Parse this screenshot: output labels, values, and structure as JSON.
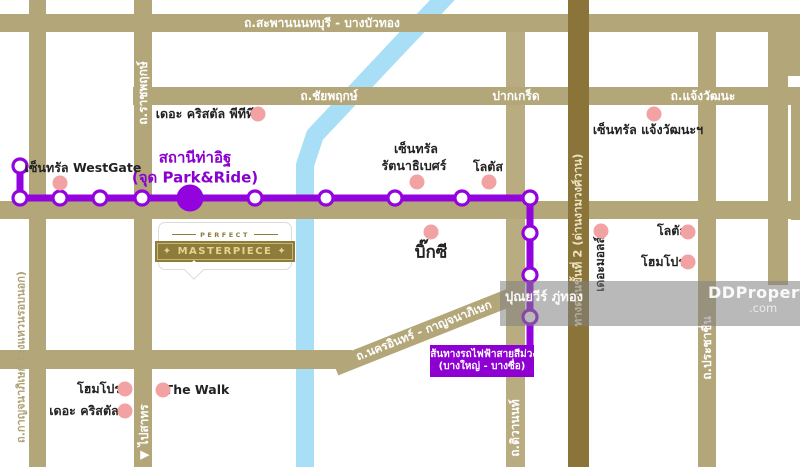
{
  "watermark": {
    "agent": "ปุณยวีร์ ภู่ทอง",
    "brand": "DDProperty",
    "brand_suffix": ".com"
  },
  "logo": {
    "eyebrow": "PERFECT",
    "name": "✦ MASTERPIECE ✦"
  },
  "metro": {
    "station": "สถานีท่าอิฐ",
    "station_note": "(จุด Park&Ride)",
    "route_line1": "เส้นทางรถไฟฟ้าสายสีม่วง",
    "route_line2": "(บางใหญ่ - บางซื่อ)"
  },
  "roads": {
    "saphan_nonthaburi": "ถ.สะพานนนทบุรี - บางบัวทอง",
    "chaiyaphruek": "ถ.ชัยพฤกษ์",
    "pak_kret": "ปากเกร็ด",
    "chaengwattana": "ถ.แจ้งวัฒนะ",
    "ratchaphruek": "ถ.ราชพฤกษ์",
    "kanchanaphisek": "ถ.กาญจนาภิเษก (วงแหวนรอบนอก)",
    "nakhon_in": "ถ.นครอินทร์ - กาญจนาภิเษก",
    "tiwanon": "ถ.ติวานนท์",
    "expressway": "ทางด่วนขั้นที่ 2 (ด่านงามวงศ์วาน)",
    "prachachuen": "ถ.ประชาชื่น",
    "to_sathorn": "▼ ไปสาทร"
  },
  "pois": {
    "crystal_ptt": "เดอะ คริสตัล พีทีที",
    "central_westgate": "เซ็นทรัล WestGate",
    "central_rattanathibet_1": "เซ็นทรัล",
    "central_rattanathibet_2": "รัตนาธิเบศร์",
    "lotus_rattanathibet": "โลตัส",
    "central_chaengwattana": "เซ็นทรัล แจ้งวัฒนะฯ",
    "big_c": "บิ๊กซี",
    "the_mall": "เดอะมอลล์",
    "lotus_chaengwattana": "โลตัส",
    "homepro_prachachuen": "โฮมโปร",
    "homepro_west": "โฮมโปร",
    "the_crystal": "เดอะ คริสตัล",
    "the_walk": "The Walk"
  },
  "colors": {
    "road": "#B3A77A",
    "road_dark_expressway": "#8A7439",
    "road_light": "#B9AC80",
    "river": "#A9DFF6",
    "metro_line": "#9203DE",
    "metro_text": "#8A00CE",
    "poi_dot": "#F2A2A2",
    "logo_gold": "#8E7C3D",
    "logo_text_gold": "#E6D488",
    "watermark_bg": "rgba(128,128,128,0.55)"
  }
}
